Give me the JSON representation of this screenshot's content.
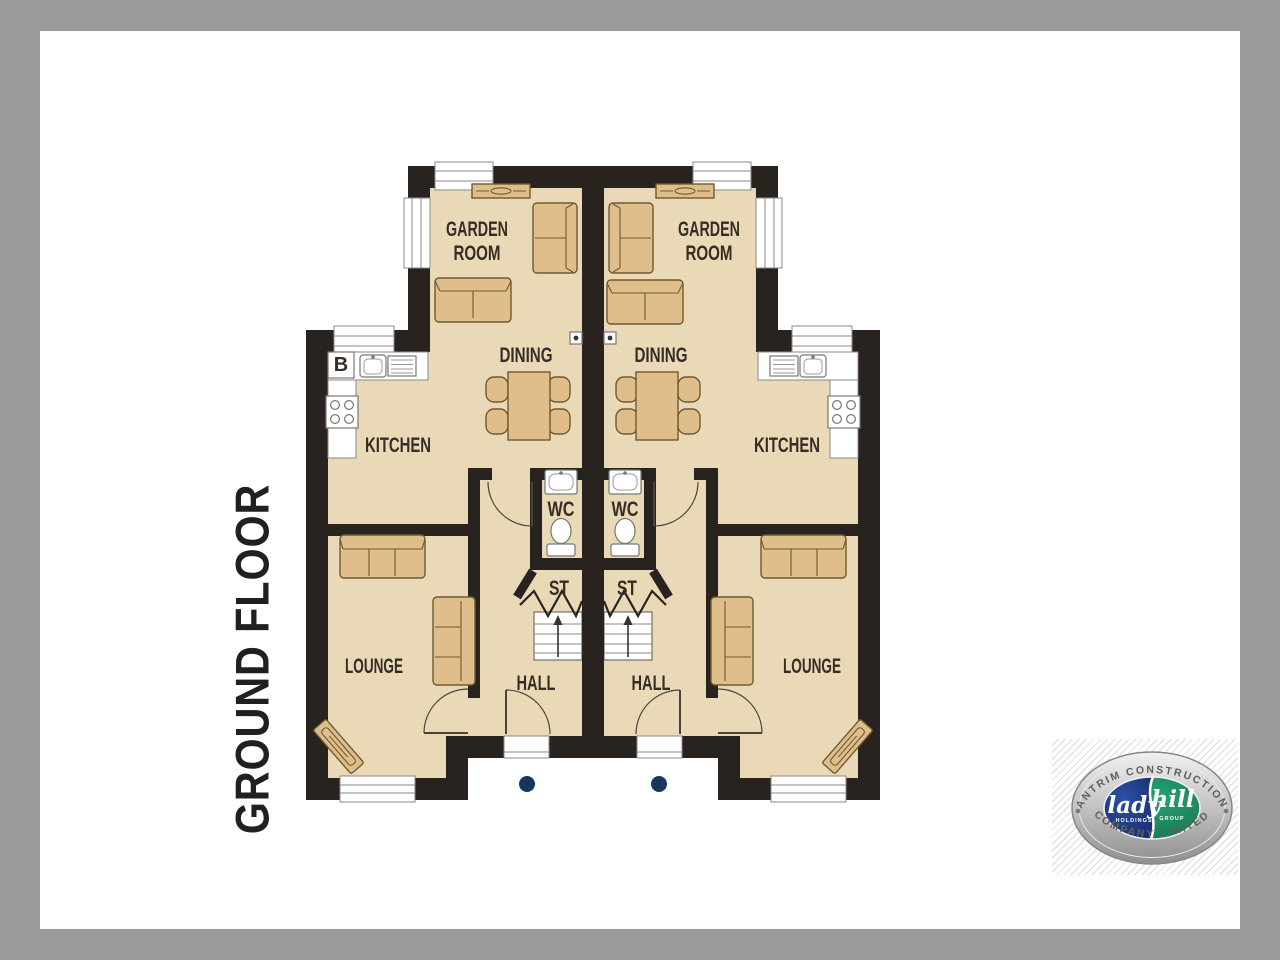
{
  "page": {
    "title": "GROUND FLOOR"
  },
  "plan": {
    "left_unit": {
      "garden_room_line1": "GARDEN",
      "garden_room_line2": "ROOM",
      "dining": "DINING",
      "kitchen": "KITCHEN",
      "wc": "WC",
      "store": "ST",
      "hall": "HALL",
      "lounge": "LOUNGE",
      "boiler": "B"
    },
    "right_unit": {
      "garden_room_line1": "GARDEN",
      "garden_room_line2": "ROOM",
      "dining": "DINING",
      "kitchen": "KITCHEN",
      "wc": "WC",
      "store": "ST",
      "hall": "HALL",
      "lounge": "LOUNGE"
    }
  },
  "logo": {
    "arc_top": "ANTRIM CONSTRUCTION",
    "arc_bottom": "COMPANY LIMITED",
    "left_word": "lady",
    "left_sub": "HOLDINGS",
    "right_word": "hill",
    "right_sub": "GROUP"
  },
  "colors": {
    "canvas": "#9b9b9b",
    "page": "#ffffff",
    "wall": "#29231f",
    "room": "#e9d9b6",
    "furniture": "#dfbe8b",
    "furniture_line": "#6f5a30",
    "fixture_line": "#8a8a8a",
    "label": "#352e27",
    "porch_dot": "#16375d",
    "logo_blue": "#1e3f8e",
    "logo_green": "#18855c",
    "logo_silver": "#c9c9c9"
  }
}
